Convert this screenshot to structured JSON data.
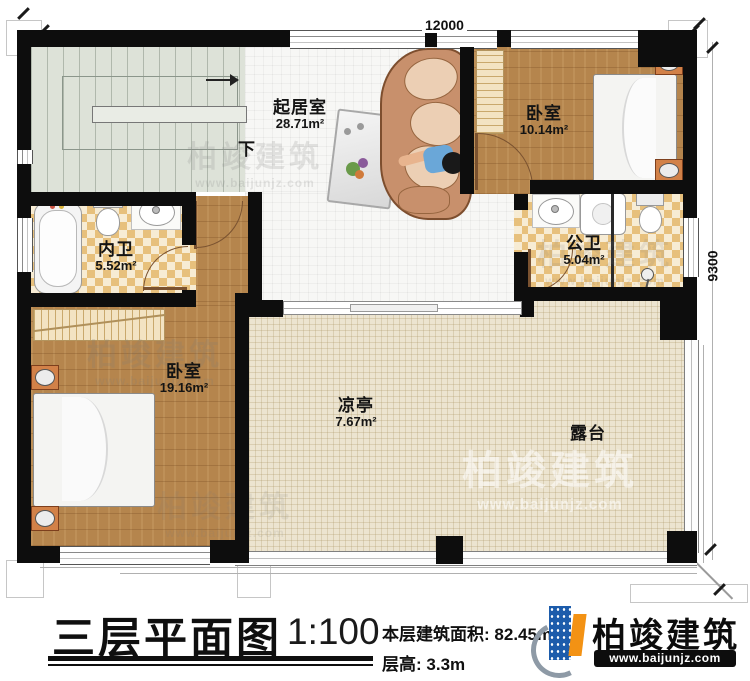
{
  "page": {
    "type": "architectural floor plan"
  },
  "dimensions": {
    "top": "12000",
    "right": "9300"
  },
  "stairs": {
    "direction_label": "下"
  },
  "rooms": {
    "living": {
      "name": "起居室",
      "area": "28.71m²"
    },
    "bedroom_top": {
      "name": "卧室",
      "area": "10.14m²"
    },
    "bath_inner": {
      "name": "内卫",
      "area": "5.52m²"
    },
    "bath_public": {
      "name": "公卫",
      "area": "5.04m²"
    },
    "bedroom_left": {
      "name": "卧室",
      "area": "19.16m²"
    },
    "pavilion": {
      "name": "凉亭",
      "area": "7.67m²"
    },
    "terrace": {
      "name": "露台"
    }
  },
  "titleblock": {
    "title": "三层平面图",
    "scale": "1:100",
    "area_label": "本层建筑面积:",
    "area_value": "82.45m²",
    "height_label": "层高:",
    "height_value": "3.3m"
  },
  "brand": {
    "name": "柏竣建筑",
    "url": "www.baijunjz.com"
  },
  "watermark": {
    "name": "柏竣建筑",
    "url": "www.baijunjz.com"
  },
  "colors": {
    "wall": "#0d0d0d",
    "wood": "#b5854d",
    "tile_check": "#e7c07c",
    "bed_blue": "#70c2dc",
    "brand_blue": "#1d5cab",
    "brand_orange": "#f39214"
  }
}
